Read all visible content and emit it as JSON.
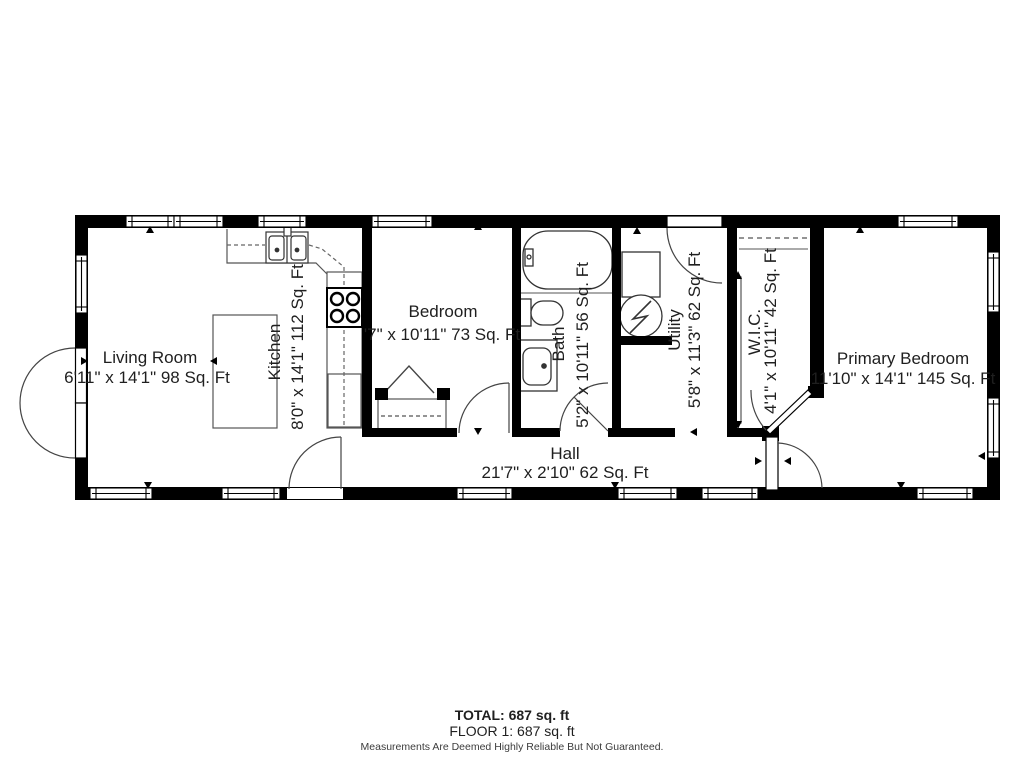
{
  "floor_plan": {
    "rooms": [
      {
        "name": "Living Room",
        "dims": "6'11\" x 14'1\" 98 Sq. Ft"
      },
      {
        "name": "Kitchen",
        "dims": "8'0\" x 14'1\" 112 Sq. Ft"
      },
      {
        "name": "Bedroom",
        "dims": "'7\" x 10'11\" 73 Sq. Ft"
      },
      {
        "name": "Bath",
        "dims": "5'2\" x 10'11\" 56 Sq. Ft"
      },
      {
        "name": "Utility",
        "dims": "5'8\" x 11'3\" 62 Sq. Ft"
      },
      {
        "name": "W.I.C.",
        "dims": "4'1\" x 10'11\" 42 Sq. Ft"
      },
      {
        "name": "Primary Bedroom",
        "dims": "11'10\" x 14'1\" 145 Sq. Ft"
      },
      {
        "name": "Hall",
        "dims": "21'7\" x 2'10\" 62 Sq. Ft"
      }
    ],
    "footer": {
      "total": "TOTAL: 687 sq. ft",
      "floor": "FLOOR 1: 687 sq. ft",
      "disclaimer": "Measurements Are Deemed Highly Reliable But Not Guaranteed."
    },
    "colors": {
      "wall": "#000000",
      "line": "#4a4a4a",
      "text": "#1f1f1f",
      "background": "#ffffff"
    }
  }
}
